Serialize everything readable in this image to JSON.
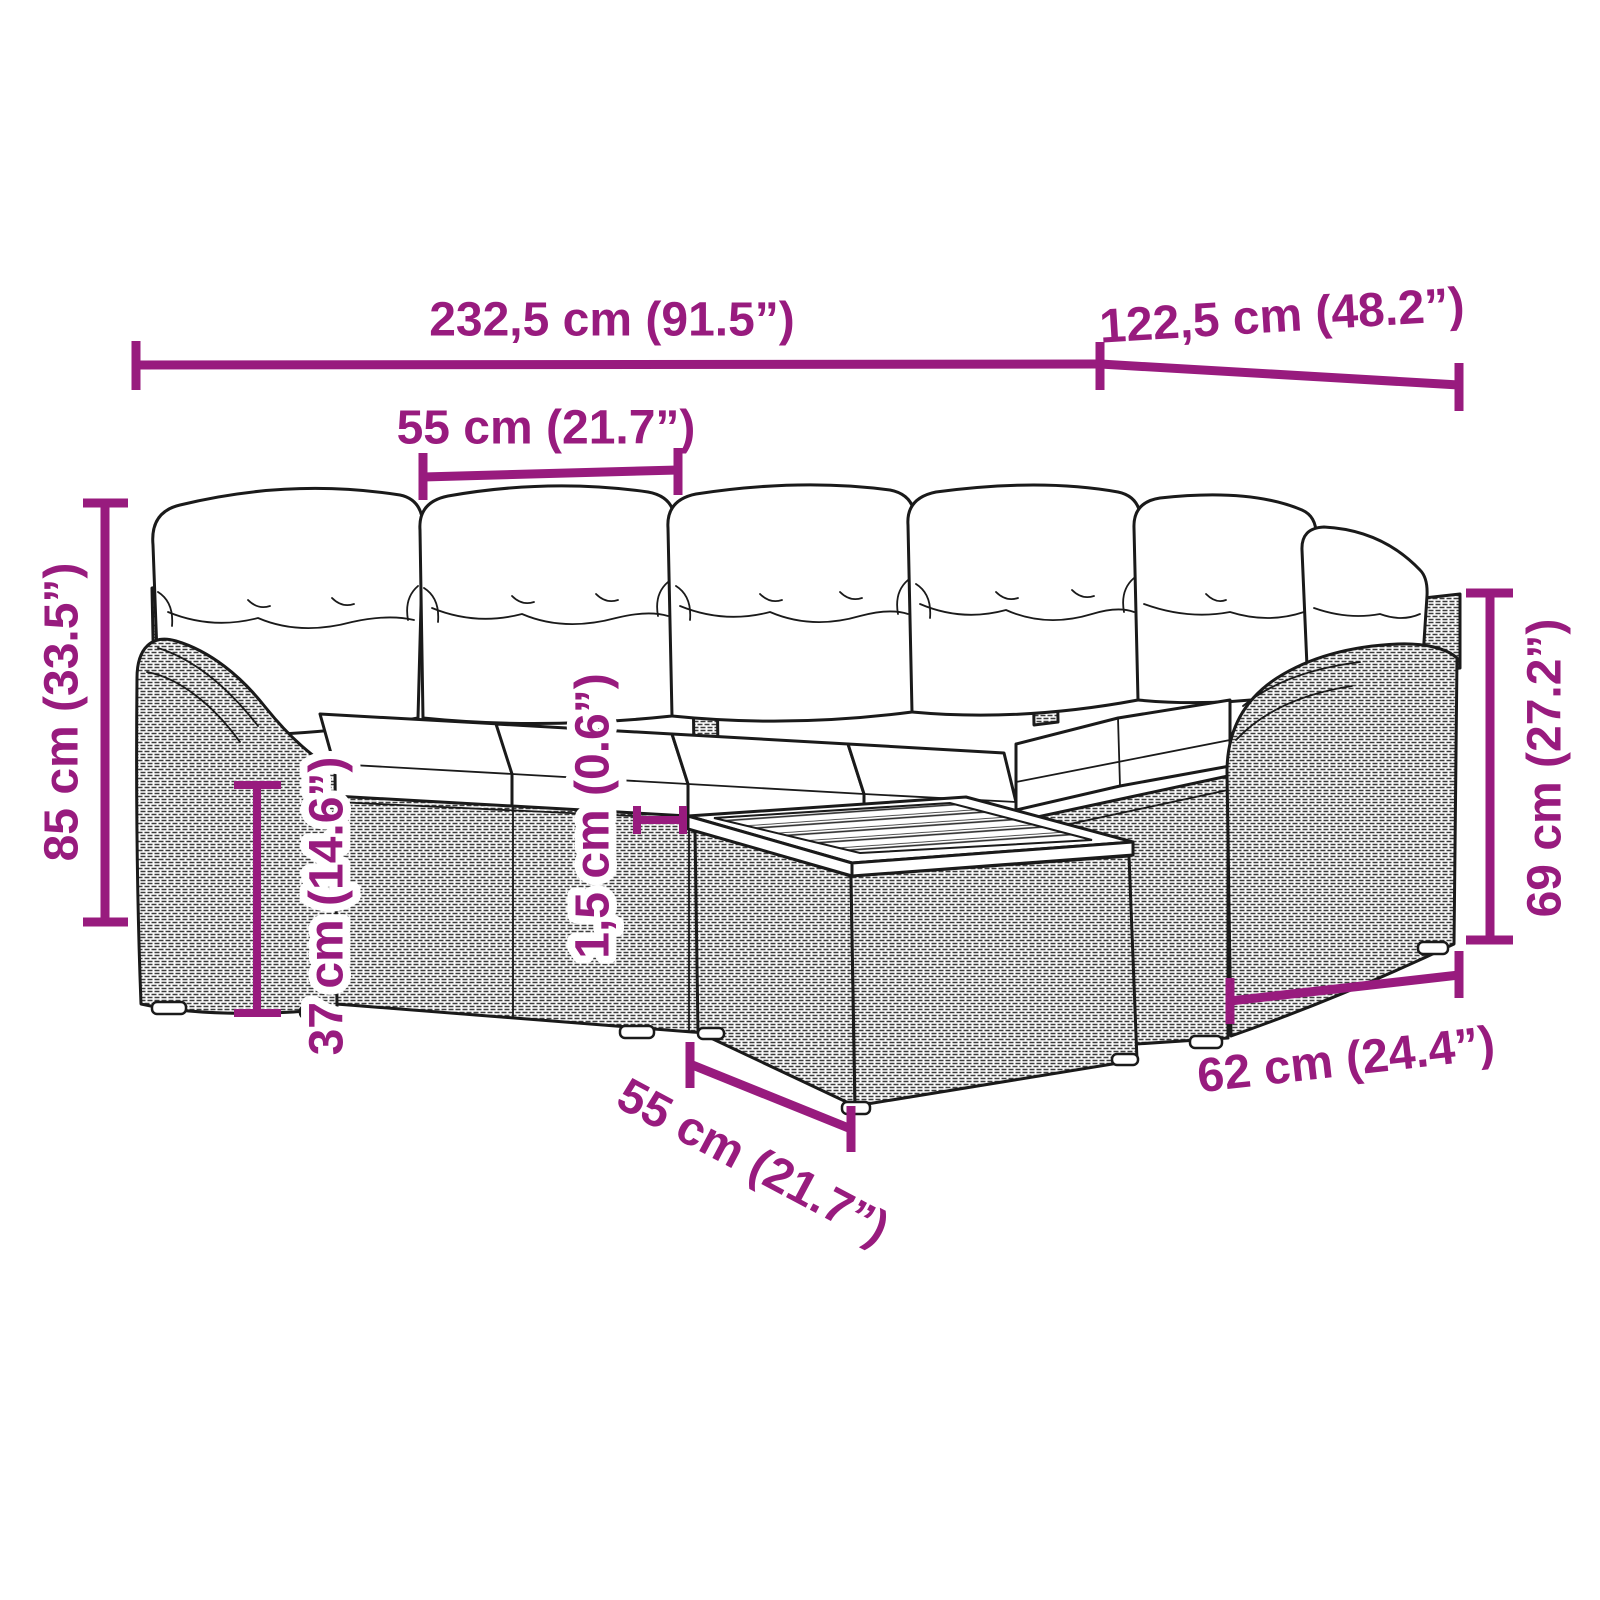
{
  "diagram": {
    "type": "product-dimension-diagram",
    "subject": "rattan garden corner sofa set with cushions and square coffee table",
    "accent_color": "#981b7e",
    "line_color": "#1a1a1a",
    "background_color": "#ffffff"
  },
  "dims": {
    "total_width": "232,5 cm (91.5”)",
    "right_depth": "122,5 cm (48.2”)",
    "seat_width": "55 cm (21.7”)",
    "total_height": "85 cm (33.5”)",
    "seat_height": "37 cm (14.6”)",
    "tabletop_thickness": "1,5 cm (0.6”)",
    "armrest_height": "69 cm (27.2”)",
    "side_depth": "62 cm (24.4”)",
    "table_width": "55 cm (21.7”)"
  }
}
